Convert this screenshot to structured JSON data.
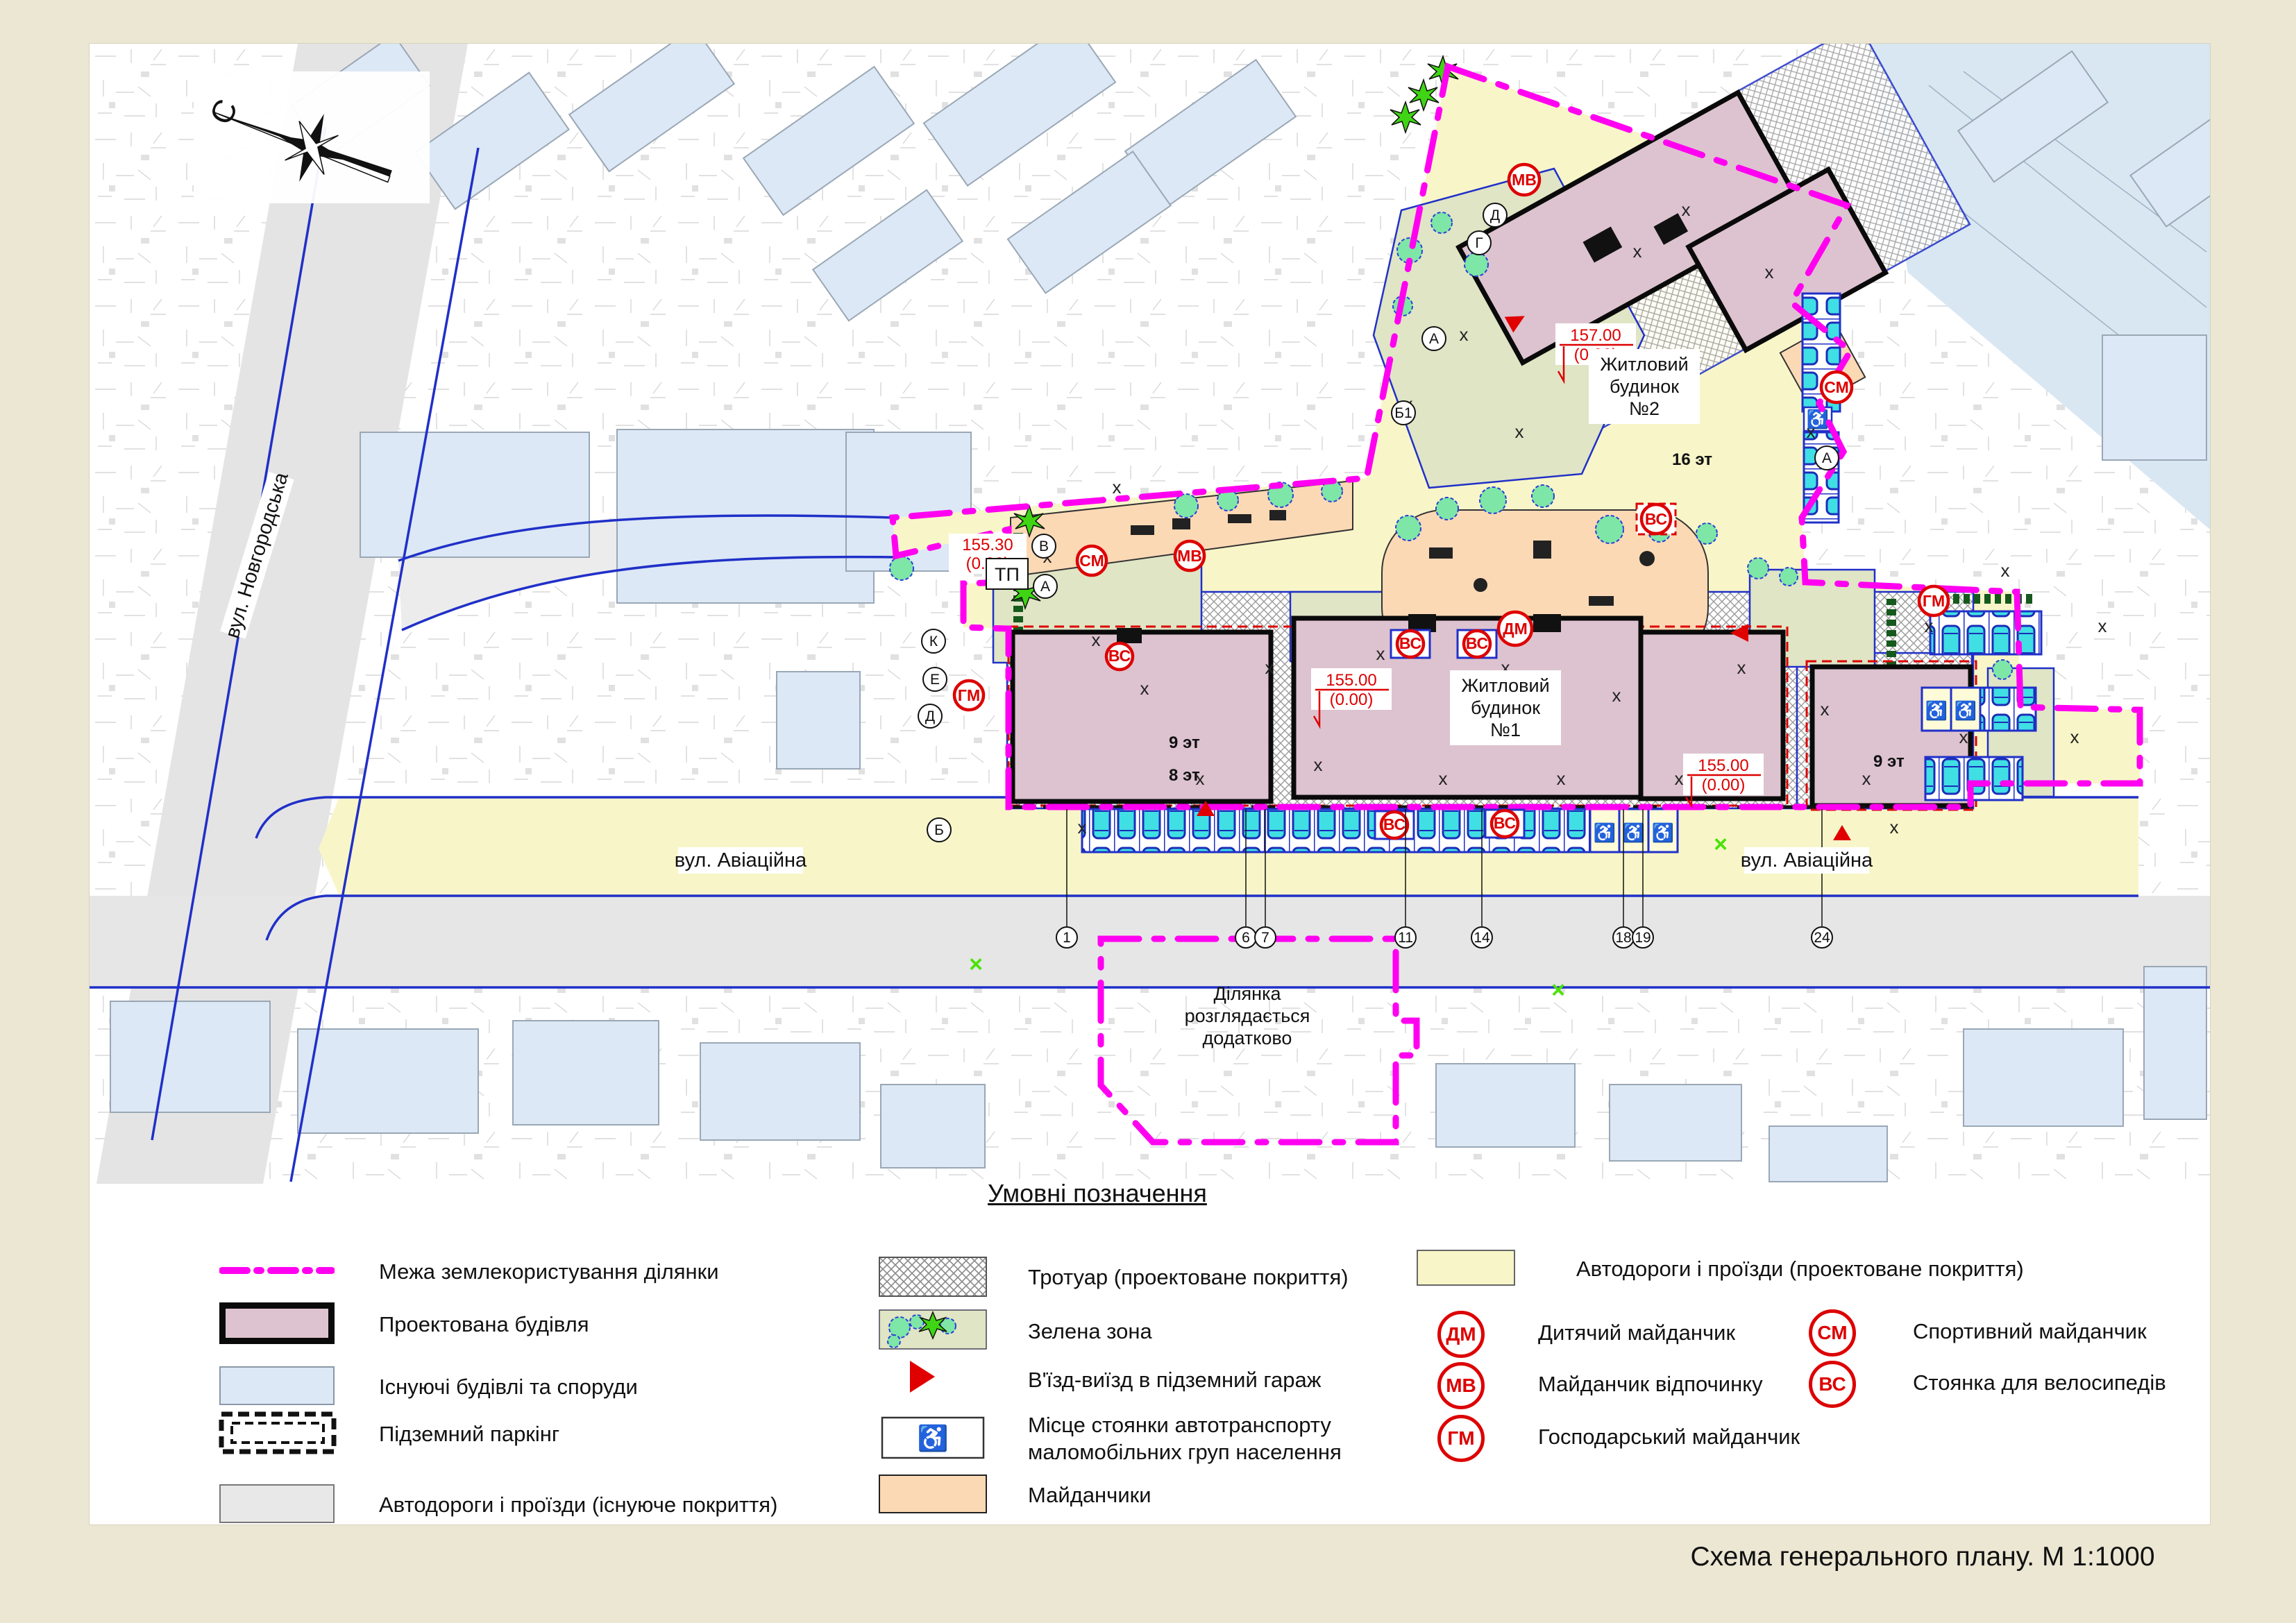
{
  "page": {
    "title": "Схема  генерального плану. М 1:1000"
  },
  "compass": {
    "north": "С"
  },
  "icons": {
    "wheelchair": "♿"
  },
  "map": {
    "street_novhorodska": "вул. Новгородська",
    "street_aviatsiina_left": "вул. Авіаційна",
    "street_aviatsiina_right": "вул. Авіаційна",
    "building1": {
      "l1": "Житловий",
      "l2": "будинок",
      "l3": "№1"
    },
    "building2": {
      "l1": "Житловий",
      "l2": "будинок",
      "l3": "№2"
    },
    "plot_note": {
      "l1": "Ділянка",
      "l2": "розглядається",
      "l3": "додатково"
    },
    "elev_157": {
      "top": "157.00",
      "bottom": "(0.00)"
    },
    "elev_155_a": {
      "top": "155.00",
      "bottom": "(0.00)"
    },
    "elev_155_b": {
      "top": "155.00",
      "bottom": "(0.00)"
    },
    "elev_155_30": {
      "top": "155.30",
      "bottom": "(0.00)"
    },
    "label_tp": "ТП",
    "floors": {
      "f16": "16 эт",
      "f13": "13 эт",
      "f12": "12 эт",
      "f11": "11 эт",
      "f9": "9 эт",
      "f8": "8 эт",
      "f9r": "9 эт"
    },
    "axes": {
      "a": "А",
      "b1": "Б1",
      "g": "Г",
      "d": "Д",
      "k": "К",
      "e": "Е",
      "b": "Б",
      "v": "В",
      "a2": "А"
    },
    "axis_numbers": [
      "1",
      "6",
      "7",
      "11",
      "14",
      "18",
      "19",
      "24"
    ]
  },
  "markers": {
    "dm": "ДМ",
    "mv": "МВ",
    "gm": "ГМ",
    "sm": "СМ",
    "vs": "ВС"
  },
  "legend": {
    "title": "Умовні позначення",
    "col1": [
      {
        "label": "Межа землекористування ділянки"
      },
      {
        "label": "Проектована будівля"
      },
      {
        "label": "Існуючі будівлі та споруди"
      },
      {
        "label": "Підземний паркінг"
      },
      {
        "label": "Автодороги і проїзди (існуюче покриття)"
      }
    ],
    "col2": [
      {
        "label": "Тротуар (проектоване покриття)"
      },
      {
        "label": "Зелена зона"
      },
      {
        "label": "В'їзд-виїзд в підземний гараж"
      },
      {
        "label": "Місце стоянки автотранспорту маломобільних груп населення"
      },
      {
        "label": "Майданчики"
      }
    ],
    "col3_road_label": "Автодороги і проїзди (проектоване покриття)",
    "col3": [
      {
        "code": "ДМ",
        "label": "Дитячий майданчик"
      },
      {
        "code": "МВ",
        "label": "Майданчик відпочинку"
      },
      {
        "code": "ГМ",
        "label": "Господарський майданчик"
      }
    ],
    "col4": [
      {
        "code": "СМ",
        "label": "Спортивний майданчик"
      },
      {
        "code": "ВС",
        "label": "Стоянка для велосипедів"
      }
    ]
  },
  "colors": {
    "boundary": "#ff00f0",
    "projected_building": "#ddc3cf",
    "existing_building": "#dce8f5",
    "green_zone": "#dfe5c5",
    "playground": "#fcd9b5",
    "road_projected": "#f8f6c8",
    "road_existing": "#e6e6e6",
    "marker_red": "#dd0000",
    "car_cyan": "#40dfe4",
    "line_blue": "#2030c8"
  }
}
